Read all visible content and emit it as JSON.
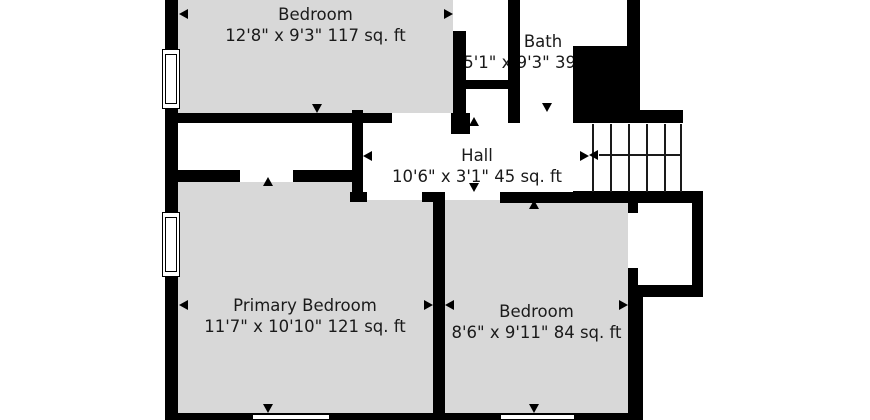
{
  "plan": {
    "type": "floor-plan",
    "colors": {
      "background": "#ffffff",
      "wall": "#000000",
      "room_fill": "#d8d8d8",
      "text": "#1a1a1a"
    },
    "rooms": [
      {
        "name": "Bedroom",
        "dimensions": "12'8\" x 9'3\" 117 sq. ft"
      },
      {
        "name": "Bath",
        "dimensions": "5'1\" x 9'3\" 39 sq. ft"
      },
      {
        "name": "Hall",
        "dimensions": "10'6\" x 3'1\" 45 sq. ft"
      },
      {
        "name": "Primary Bedroom",
        "dimensions": "11'7\" x 10'10\" 121 sq. ft"
      },
      {
        "name": "Bedroom",
        "dimensions": "8'6\" x 9'11\" 84 sq. ft"
      }
    ],
    "stairs": {
      "treads": 6,
      "direction_arrow": "left"
    },
    "icons": {
      "dimension_markers": "small black triangles at measured wall extents",
      "stair_arrow": "arrow-left-icon"
    },
    "windows_visible": 4
  }
}
